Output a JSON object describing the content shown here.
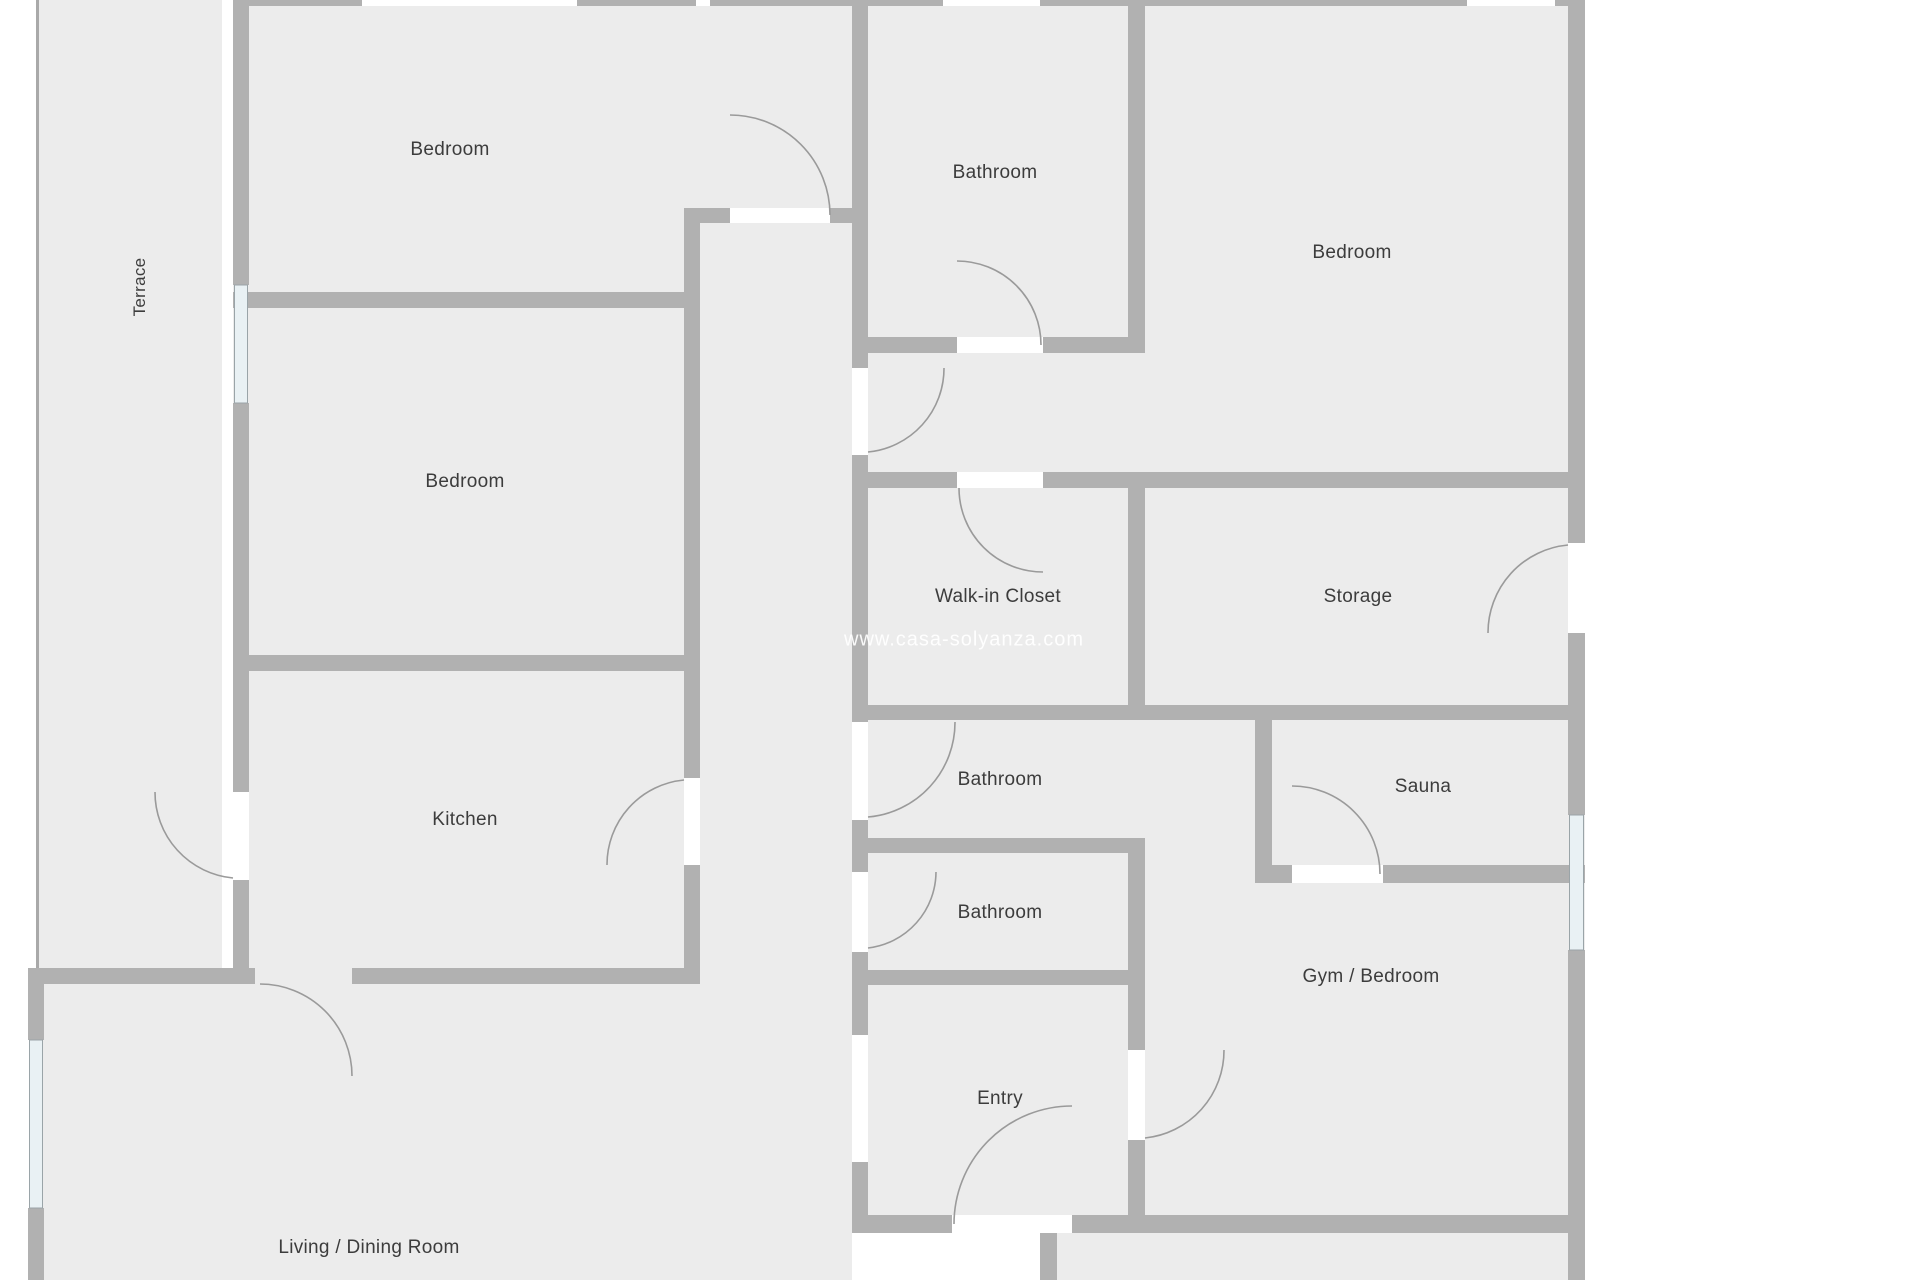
{
  "plan": {
    "watermark": "www.casa-solyanza.com",
    "colors": {
      "floor": "#ececec",
      "wall": "#b1b1b1",
      "wall_thin": "#a9a9a9",
      "door_arc": "#9a9a9a",
      "window_fill": "#e9f1f4",
      "window_frame": "#9aa4a8",
      "label_text": "#3c3c3c",
      "background": "#ffffff"
    },
    "rooms": {
      "terrace": {
        "label": "Terrace"
      },
      "bedroom_top_left": {
        "label": "Bedroom"
      },
      "bathroom_top": {
        "label": "Bathroom"
      },
      "bedroom_top_right": {
        "label": "Bedroom"
      },
      "bedroom_middle": {
        "label": "Bedroom"
      },
      "kitchen": {
        "label": "Kitchen"
      },
      "walk_in_closet": {
        "label": "Walk-in Closet"
      },
      "storage": {
        "label": "Storage"
      },
      "bathroom_middle": {
        "label": "Bathroom"
      },
      "bathroom_lower": {
        "label": "Bathroom"
      },
      "sauna": {
        "label": "Sauna"
      },
      "gym_bedroom": {
        "label": "Gym / Bedroom"
      },
      "entry": {
        "label": "Entry"
      },
      "living_dining": {
        "label": "Living / Dining Room"
      }
    }
  }
}
